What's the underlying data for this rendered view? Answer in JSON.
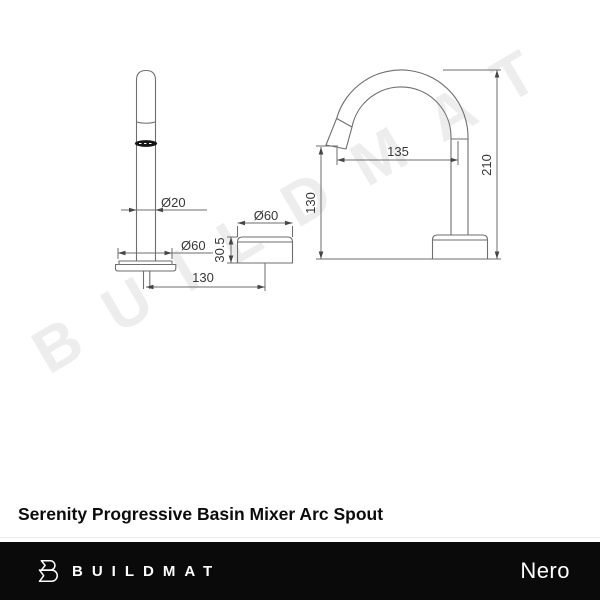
{
  "title": "Serenity Progressive Basin Mixer Arc Spout",
  "watermark": "BUILDMAT",
  "drawing": {
    "front": {
      "shaft_dia": "Ø20",
      "flange_dia": "Ø60",
      "spacing": "130"
    },
    "control": {
      "dia": "Ø60",
      "height": "30.5"
    },
    "side": {
      "reach": "135",
      "tip_height": "130",
      "total_height": "210"
    }
  },
  "footer": {
    "brand": "BUILDMAT",
    "partner_brand": "Nero"
  }
}
